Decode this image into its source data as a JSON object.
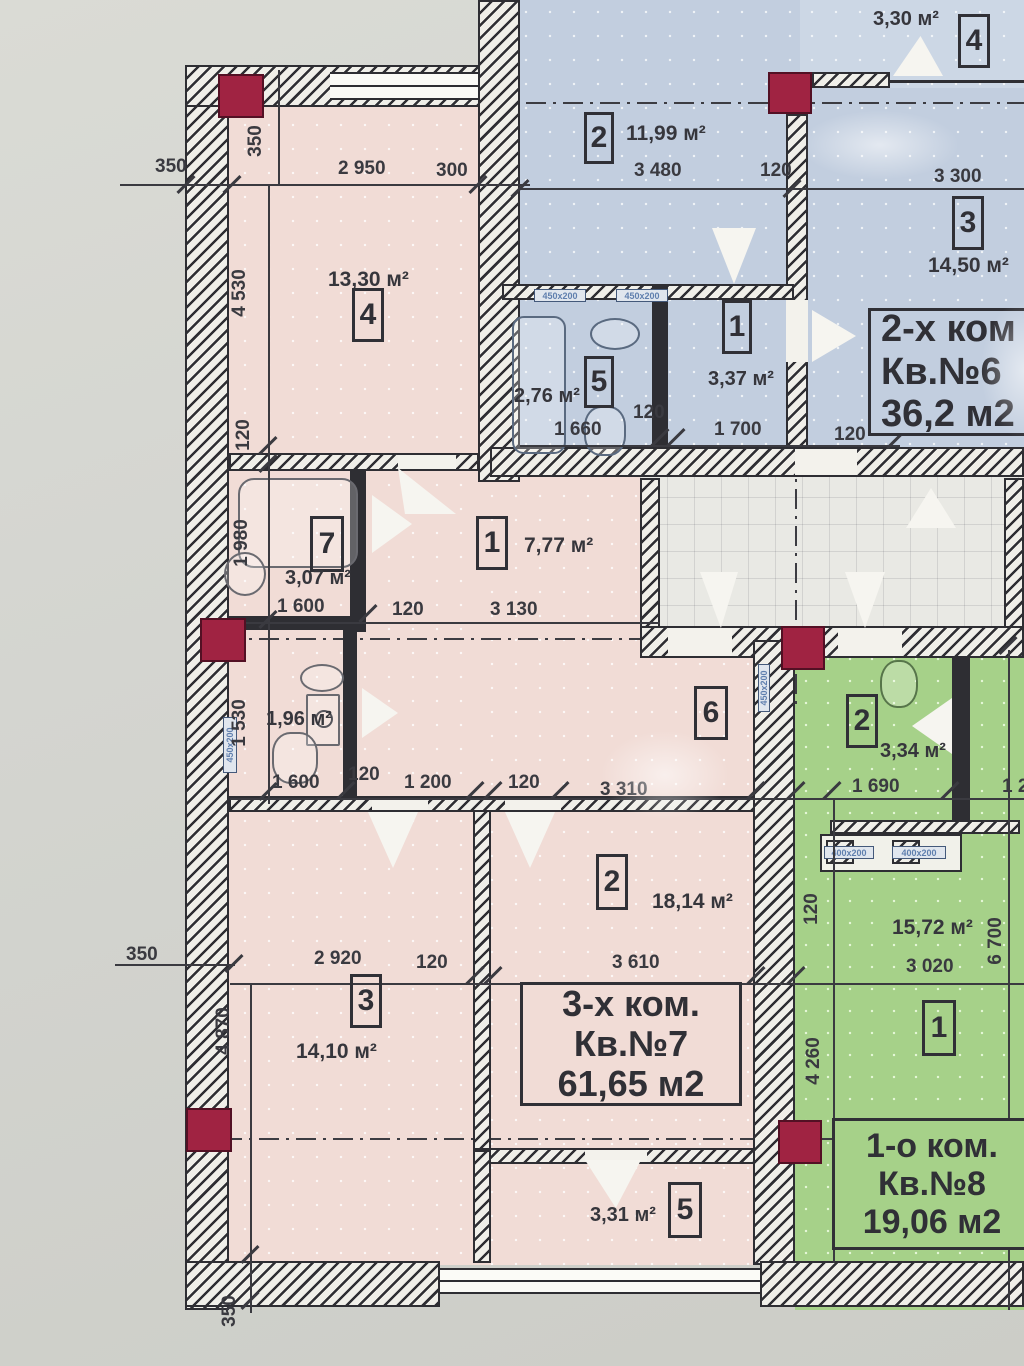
{
  "apartments": {
    "apt6": {
      "type_label": "2-х ком",
      "unit_label": "Кв.№6",
      "area_label": "36,2 м2"
    },
    "apt7": {
      "type_label": "3-х ком.",
      "unit_label": "Кв.№7",
      "area_label": "61,65 м2"
    },
    "apt8": {
      "type_label": "1-о ком.",
      "unit_label": "Кв.№8",
      "area_label": "19,06 м2"
    }
  },
  "rooms": {
    "apt6_r2": {
      "num": "2",
      "area": "11,99 м²"
    },
    "apt6_r4": {
      "num": "4",
      "area": "3,30 м²"
    },
    "apt6_r3": {
      "num": "3",
      "area": "14,50 м²"
    },
    "apt6_r1": {
      "num": "1",
      "area": "3,37 м²"
    },
    "apt6_r5": {
      "num": "5",
      "area": "2,76 м²"
    },
    "apt7_r4": {
      "num": "4",
      "area": "13,30 м²"
    },
    "apt7_r7": {
      "num": "7",
      "area": "3,07 м²"
    },
    "apt7_r1": {
      "num": "1",
      "area": "7,77 м²"
    },
    "apt7_r6": {
      "num": "6",
      "area": "1,96 м²"
    },
    "apt7_r2": {
      "num": "2",
      "area": "18,14 м²"
    },
    "apt7_r3": {
      "num": "3",
      "area": "14,10 м²"
    },
    "apt7_r5": {
      "num": "5",
      "area": "3,31 м²"
    },
    "apt8_r2": {
      "num": "2",
      "area": "3,34 м²"
    },
    "apt8_r1": {
      "num": "1",
      "area": "15,72 м²"
    }
  },
  "dims": {
    "t350a": "350",
    "t350b": "350",
    "t2950": "2 950",
    "t300": "300",
    "v4530": "4 530",
    "v120a": "120",
    "v1980": "1 980",
    "v1530": "1 530",
    "t1600a": "1 600",
    "t120b": "120",
    "t3130": "3 130",
    "t1600b": "1 600",
    "t120c": "120",
    "t1200": "1 200",
    "t120d": "120",
    "t3310": "3 310",
    "t3480": "3 480",
    "t120e": "120",
    "t3300": "3 300",
    "t1660": "1 660",
    "t120f": "120",
    "t1700": "1 700",
    "t120g": "120",
    "t1690": "1 690",
    "t12cut": "1 2",
    "v120h": "120",
    "v6700": "6 700",
    "t3020": "3 020",
    "v4260": "4 260",
    "t350c": "350",
    "v4870": "4 870",
    "t2920": "2 920",
    "t120i": "120",
    "t3610": "3 610",
    "v350d": "350"
  },
  "vents": {
    "v450": "450x200",
    "v400": "400x200"
  },
  "colors": {
    "apt6_fill": "#c2cedf",
    "apt7_fill": "#f1dcd6",
    "apt8_fill": "#a6d189",
    "column": "#a02342",
    "wall": "#2e2e33",
    "text": "#3a3a40"
  }
}
